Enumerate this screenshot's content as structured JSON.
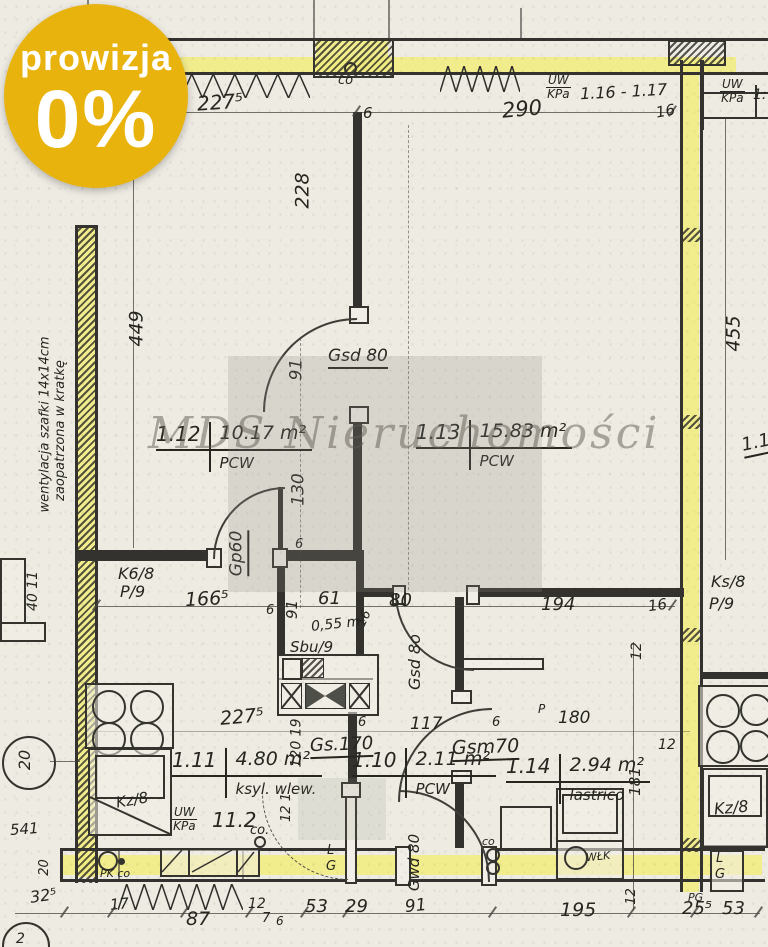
{
  "colors": {
    "badge": "#e9b30d",
    "highlight": "#f1ec7c",
    "paper": "#edebe2",
    "ink": "#33322e"
  },
  "badge": {
    "line1": "prowizja",
    "line2": "0%"
  },
  "watermark": {
    "text": "MDS Nieruchomości"
  },
  "rooms": {
    "r112": {
      "no": "1.12",
      "area": "10.17 m²",
      "floor": "PCW"
    },
    "r113": {
      "no": "1.13",
      "area": "15.83 m²",
      "floor": "PCW"
    },
    "r111": {
      "no": "1.11",
      "area": "4.80 m²",
      "floor": "ksyl. wlew."
    },
    "r110": {
      "no": "1.10",
      "area": "2.11 m²",
      "floor": "PCW"
    },
    "r114": {
      "no": "1.14",
      "area": "2.94 m²",
      "floor": "lastrico"
    },
    "wc": {
      "area": "0,55 m²"
    },
    "edge": {
      "no": "1.1"
    }
  },
  "doors": {
    "gsd80": "Gsd 80",
    "gp60": "Gp60",
    "gsd8o": "Gsd 8o",
    "gs170": "Gs.170",
    "gsm70": "Gsm70",
    "gwd80": "Gwd 80"
  },
  "shafts": {
    "sbu": "Sbu/9",
    "k68": "K6/8",
    "p9_left": "P/9",
    "ks8": "Ks/8",
    "p9_right": "P/9",
    "kz8_left": "Kz/8",
    "kz8_right": "Kz/8"
  },
  "equipment": {
    "wlk": "WŁK",
    "pk_co": "PK co",
    "co_top": "co",
    "co_bath": "co",
    "co_kitchen": "co.",
    "p": "P",
    "l_mid": "L",
    "g_mid": "G",
    "l_box": "L",
    "g_box": "G",
    "pg": "PG"
  },
  "install": {
    "top": {
      "num": "UW",
      "den": "KPa",
      "val": "1.16 - 1.17"
    },
    "tr": {
      "num": "UW",
      "den": "KPa",
      "val": "1:"
    },
    "kitchen": {
      "num": "UW",
      "den": "KPa",
      "val": "11.2"
    }
  },
  "notes": {
    "vent1": "wentylacja szafki 14x14cm",
    "vent2": "zaopatrzona w kratkę"
  },
  "axes": {
    "a20": "20",
    "a2": "2"
  },
  "dims": {
    "t2275": "227⁵",
    "t290": "290",
    "t16": "16",
    "t6": "6",
    "v228": "228",
    "v449": "449",
    "v455": "455",
    "d91a": "91",
    "d130": "130",
    "d1665": "166⁵",
    "d6a": "6",
    "d91b": "91",
    "d6b": "6",
    "d61": "61",
    "d80": "80",
    "d16a": "16",
    "d194": "194",
    "d16b": "16",
    "d12a": "12",
    "b2275": "227⁵",
    "d117": "117",
    "d6c": "6",
    "d6d": "6",
    "d180": "180",
    "d12b": "12",
    "v181": "181",
    "v12019": "120 19",
    "v121": "12 1",
    "v4011": "40 11",
    "d541": "541",
    "v20": "20",
    "d325": "32⁵",
    "d17": "17",
    "d87": "87",
    "d12c": "12",
    "d7": "7",
    "d6e": "6",
    "d53a": "53",
    "d29": "29",
    "d91c": "91",
    "d195": "195",
    "v12b": "12",
    "d255": "25⁵",
    "d53b": "53"
  }
}
